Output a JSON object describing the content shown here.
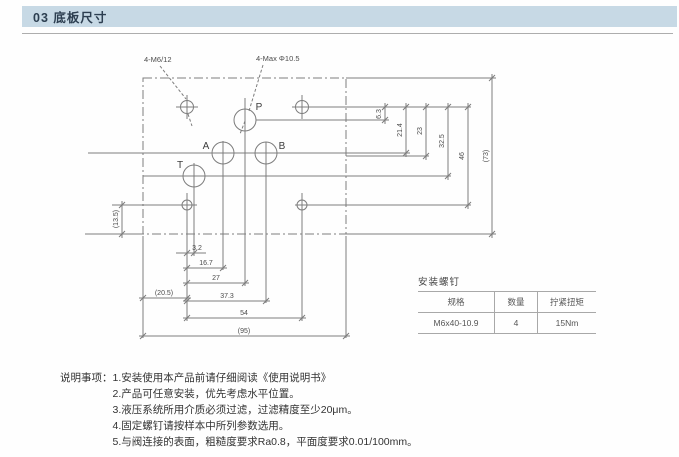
{
  "header": {
    "title": "03 底板尺寸"
  },
  "colors": {
    "header_bg": "#c7d9e5",
    "line_gray": "#7d7d7d"
  },
  "drawing": {
    "callouts": {
      "thread": "4-M6/12",
      "ports_max": "4-Max Φ10.5"
    },
    "ports": {
      "p": "P",
      "a": "A",
      "b": "B",
      "t": "T"
    },
    "dims": {
      "vertical_right": [
        "6.3",
        "21.4",
        "23",
        "32.5",
        "46",
        "(73)"
      ],
      "horizontal_bottom": [
        "3.2",
        "16.7",
        "27",
        "37.3",
        "54",
        "(95)"
      ],
      "left_margin": "(20.5)",
      "left_vertical": "(13.5)"
    }
  },
  "screw_table": {
    "title": "安装螺钉",
    "headers": [
      "规格",
      "数量",
      "拧紧扭矩"
    ],
    "rows": [
      [
        "M6x40-10.9",
        "4",
        "15Nm"
      ]
    ]
  },
  "notes": {
    "label": "说明事项：",
    "items": [
      "1.安装使用本产品前请仔细阅读《使用说明书》",
      "2.产品可任意安装，优先考虑水平位置。",
      "3.液压系统所用介质必须过滤，过滤精度至少20μm。",
      "4.固定螺钉请按样本中所列参数选用。",
      "5.与阀连接的表面，粗糙度要求Ra0.8，平面度要求0.01/100mm。"
    ]
  }
}
